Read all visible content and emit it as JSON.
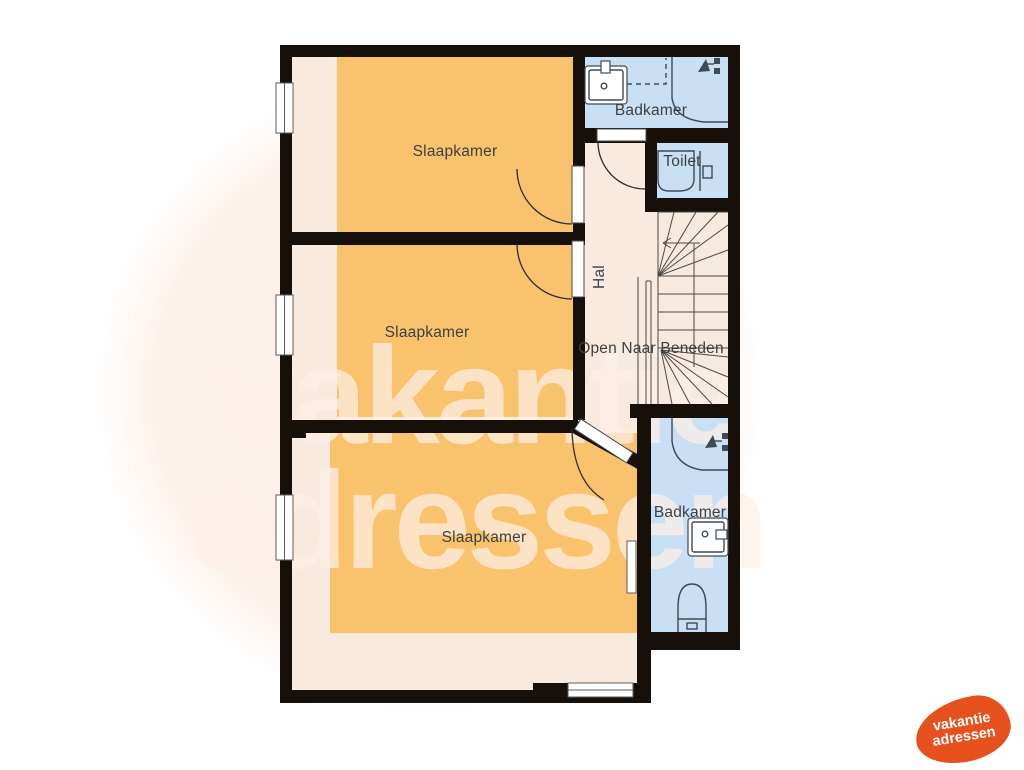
{
  "floorplan": {
    "rooms": {
      "bedroom_top": "Slaapkamer",
      "bedroom_middle": "Slaapkamer",
      "bedroom_bottom": "Slaapkamer",
      "bathroom_top": "Badkamer",
      "bathroom_bottom": "Badkamer",
      "toilet": "Toilet",
      "hall": "Hal",
      "stairs_note": "Open Naar Beneden"
    },
    "icons": {
      "sink": "sink-icon",
      "shower": "shower-head-icon",
      "toilet": "toilet-icon",
      "stairs": "staircase-with-direction-arrow",
      "door": "door-swing-arc",
      "window": "window-symbol",
      "radiator": "radiator-symbol"
    }
  },
  "watermark": {
    "line1": "vakantie",
    "line2": "adressen"
  },
  "logo": {
    "line1": "vakantie",
    "line2": "adressen"
  },
  "palette": {
    "wall": "#170f0a",
    "room_cream": "#f8eade",
    "room_orange": "#f9c36d",
    "bath_blue": "#c9dff4",
    "fixture": "#3e4a54",
    "label": "#3d4043",
    "watermark": "rgba(253,240,232,0.72)",
    "blob": "#fcf1ea",
    "logo_orange": "#e6511e"
  }
}
